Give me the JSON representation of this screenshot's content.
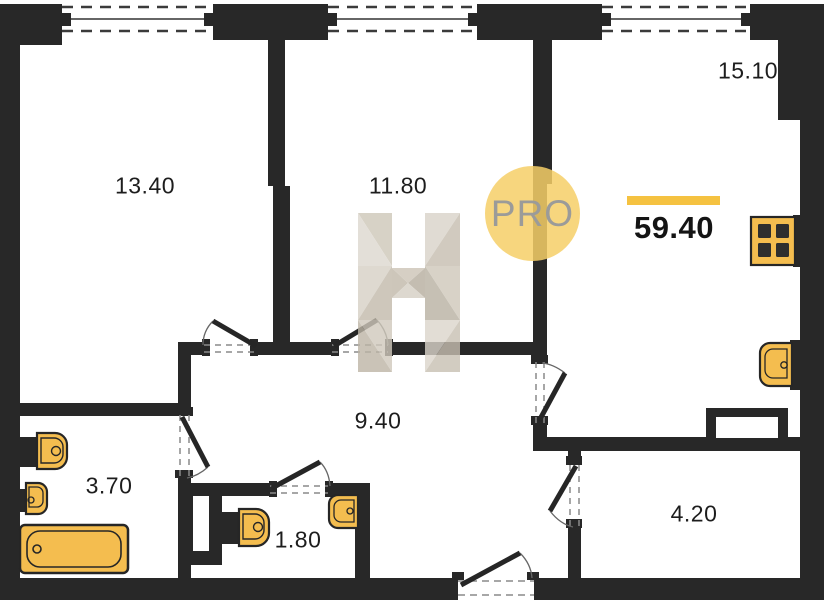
{
  "branding": {
    "logo_text": "PRO",
    "watermark_letter": "H",
    "logo_circle_color": "#f6cf67",
    "logo_text_color": "#9b9b99"
  },
  "total_area": {
    "value": "59.40",
    "accent_bar_color": "#f5c241"
  },
  "rooms": [
    {
      "id": "room-top-left",
      "area": "13.40"
    },
    {
      "id": "room-top-middle",
      "area": "11.80"
    },
    {
      "id": "room-top-right",
      "area": "15.10"
    },
    {
      "id": "hallway",
      "area": "9.40"
    },
    {
      "id": "bathroom",
      "area": "3.70"
    },
    {
      "id": "wc",
      "area": "1.80"
    },
    {
      "id": "entry",
      "area": "4.20"
    }
  ],
  "fixtures": [
    "bathtub-icon",
    "toilet-icon",
    "toilet-icon",
    "sink-icon",
    "sink-icon",
    "sink-icon",
    "stove-icon",
    "vent-shaft"
  ],
  "features": {
    "windows": 3,
    "doors": 7
  },
  "colors": {
    "wall": "#282828",
    "fixture_fill": "#f4bd4f",
    "accent_bar": "#f5c241",
    "watermark_tint": "#cfc8bb"
  }
}
